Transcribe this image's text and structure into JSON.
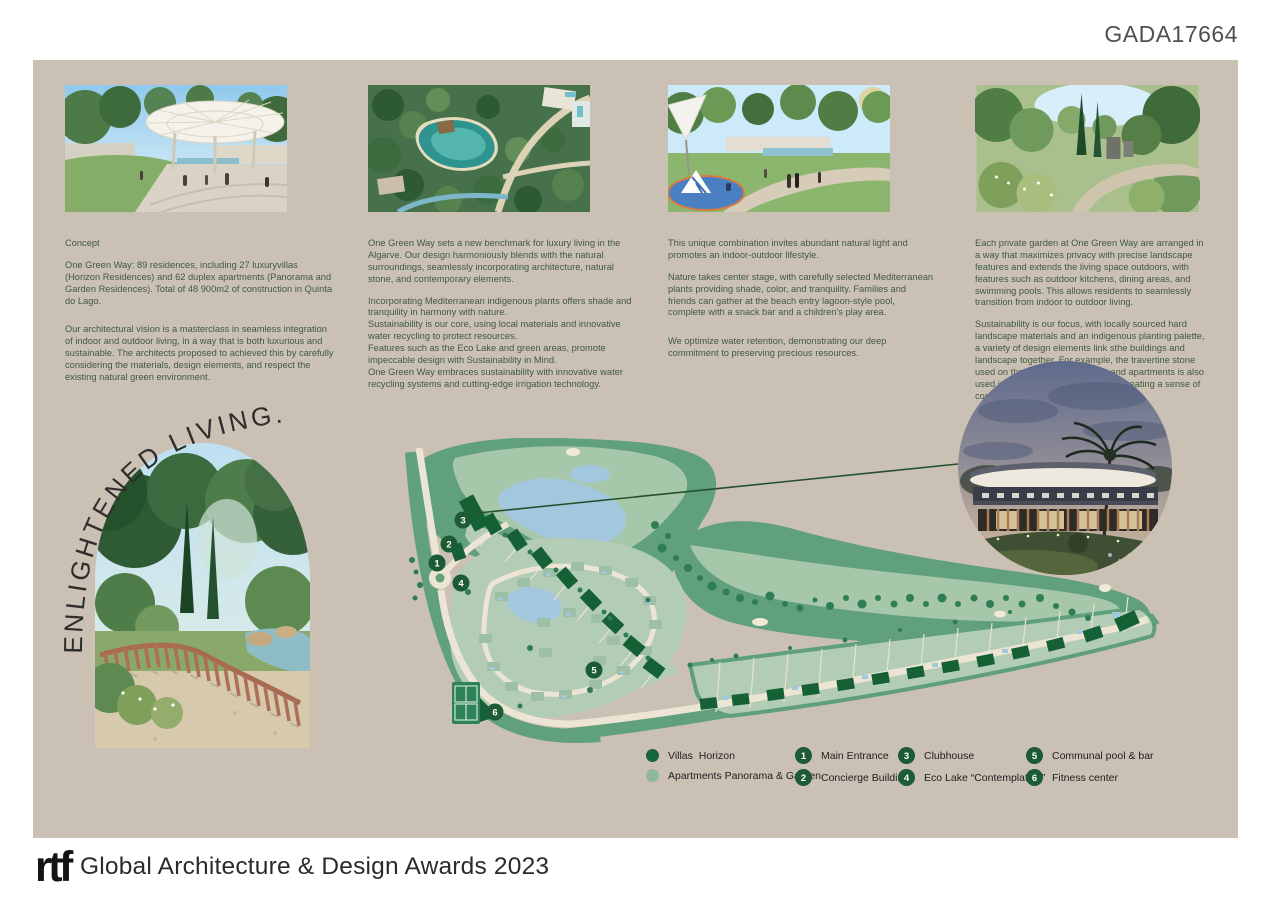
{
  "header": {
    "code": "GADA17664"
  },
  "columns": [
    {
      "title": "Concept",
      "p1": "One Green Way: 89 residences, including 27 luxuryvillas (Horizon Residences) and 62 duplex apartments (Panorama and Garden Residences). Total of 48 900m2 of construction in Quinta do Lago.",
      "p2": "Our architectural vision is a masterclass in seamless integration of indoor and outdoor living, in a way that is both luxurious and sustainable. The architects proposed to achieved this by carefully considering the materials, design elements, and respect the existing natural green environment."
    },
    {
      "p1": "One Green Way sets a new benchmark for luxury living in the Algarve. Our design harmoniously blends with the natural surroundings, seamlessly incorporating  architecture, natural stone, and contemporary elements.",
      "p2": "Incorporating Mediterranean indigenous plants offers shade and tranquility in harmony with nature.",
      "p3": "Sustainability is our core, using local materials and innovative water recycling to protect resources.",
      "p4": "Features such as the Eco Lake and green areas, promote impeccable design with Sustainability in Mind.",
      "p5": "One Green Way embraces sustainability with innovative water recycling systems and cutting-edge irrigation technology."
    },
    {
      "p1": "This unique combination invites abundant natural light and promotes an indoor-outdoor lifestyle.",
      "p2": "Nature takes center stage, with carefully selected Mediterranean plants providing shade, color, and tranquility. Families and friends can gather at the beach entry lagoon-style pool, complete with a snack bar and a children's play area.",
      "p3": "We optimize water retention, demonstrating our deep commitment to preserving precious resources."
    },
    {
      "p1": "Each private garden at One Green Way are arranged in a way that maximizes privacy with precise landscape features and extends the living space outdoors, with features such as outdoor kitchens, dining areas, and swimming pools. This allows residents to seamlessly transition from indoor to outdoor living.",
      "p2": "Sustainability is our focus, with locally sourced hard landscape materials and an indigenous planting palette, a variety of design elements link sthe buildings and landscape together. For example, the travertine stone used on the facades of the villas and apartments is also used in the landscape architecture, creating a sense of continuity between the two."
    }
  ],
  "hero": {
    "tagline": "ENLIGHTENED LIVING."
  },
  "map": {
    "markers": [
      "1",
      "2",
      "3",
      "4",
      "5",
      "6"
    ]
  },
  "legend": {
    "types": [
      {
        "label": "Villas  Horizon",
        "color": "#17663a"
      },
      {
        "label": "Apartments Panorama & Garden",
        "color": "#8fb89a"
      }
    ],
    "numbered": [
      {
        "number": "1",
        "label": "Main Entrance"
      },
      {
        "number": "2",
        "label": "Concierge Building"
      },
      {
        "number": "3",
        "label": "Clubhouse"
      },
      {
        "number": "4",
        "label": "Eco Lake “Contemplation”"
      },
      {
        "number": "5",
        "label": "Communal pool & bar"
      },
      {
        "number": "6",
        "label": "Fitness center"
      }
    ]
  },
  "footer": {
    "logo": "rtf",
    "text": "Global Architecture & Design Awards 2023"
  },
  "colors": {
    "board_bg": "#cac0b4",
    "text_green": "#3f5a3d",
    "marker_green": "#1d5b34",
    "villa_green": "#156135",
    "apartment_sage": "#b3ccb6",
    "lake_blue": "#a3c8de"
  }
}
